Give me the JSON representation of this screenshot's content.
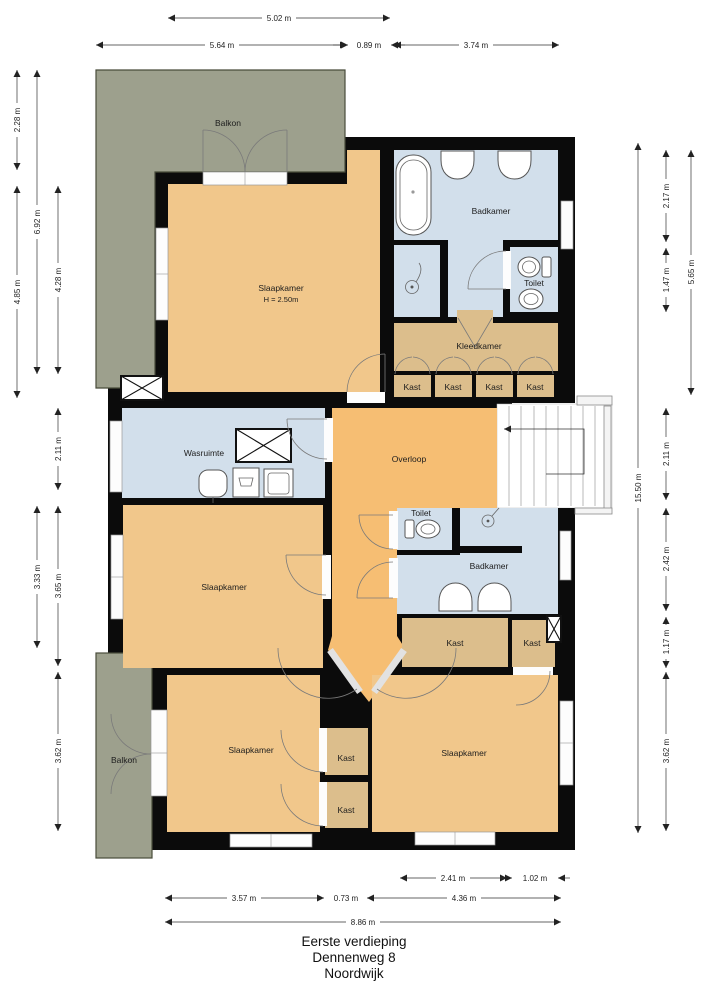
{
  "colors": {
    "wall": "#0b0b0b",
    "bedroom": "#f1c78b",
    "hall": "#f6be73",
    "wet": "#d2dfeb",
    "closet": "#dcbe8c",
    "balcony": "#9da08d"
  },
  "rooms": {
    "balkon_top": "Balkon",
    "slaapkamer_main": "Slaapkamer",
    "slaapkamer_main_height": "H = 2.50m",
    "badkamer_top": "Badkamer",
    "toilet_top": "Toilet",
    "kleedkamer": "Kleedkamer",
    "kast_row": [
      "Kast",
      "Kast",
      "Kast",
      "Kast"
    ],
    "wasruimte": "Wasruimte",
    "overloop": "Overloop",
    "slaapkamer_mid": "Slaapkamer",
    "toilet_mid": "Toilet",
    "badkamer_mid": "Badkamer",
    "kast_mid_left": "Kast",
    "kast_mid_right": "Kast",
    "balkon_bottom": "Balkon",
    "slaapkamer_bottom_left": "Slaapkamer",
    "kast_bottom": [
      "Kast",
      "Kast"
    ],
    "slaapkamer_bottom_right": "Slaapkamer"
  },
  "dimensions": {
    "top": [
      "5.02 m",
      "5.64 m",
      "0.89 m",
      "3.74 m"
    ],
    "left": [
      "2.28 m",
      "6.92 m",
      "4.85 m",
      "4.28 m",
      "2.11 m",
      "3.33 m",
      "3.65 m",
      "3.62 m"
    ],
    "right": [
      "15.50 m",
      "2.17 m",
      "1.47 m",
      "2.11 m",
      "2.42 m",
      "1.17 m",
      "3.62 m",
      "5.65 m"
    ],
    "bottom": [
      "2.41 m",
      "1.02 m",
      "3.57 m",
      "0.73 m",
      "4.36 m",
      "8.86 m"
    ]
  },
  "title": {
    "line1": "Eerste verdieping",
    "line2": "Dennenweg 8",
    "line3": "Noordwijk"
  }
}
